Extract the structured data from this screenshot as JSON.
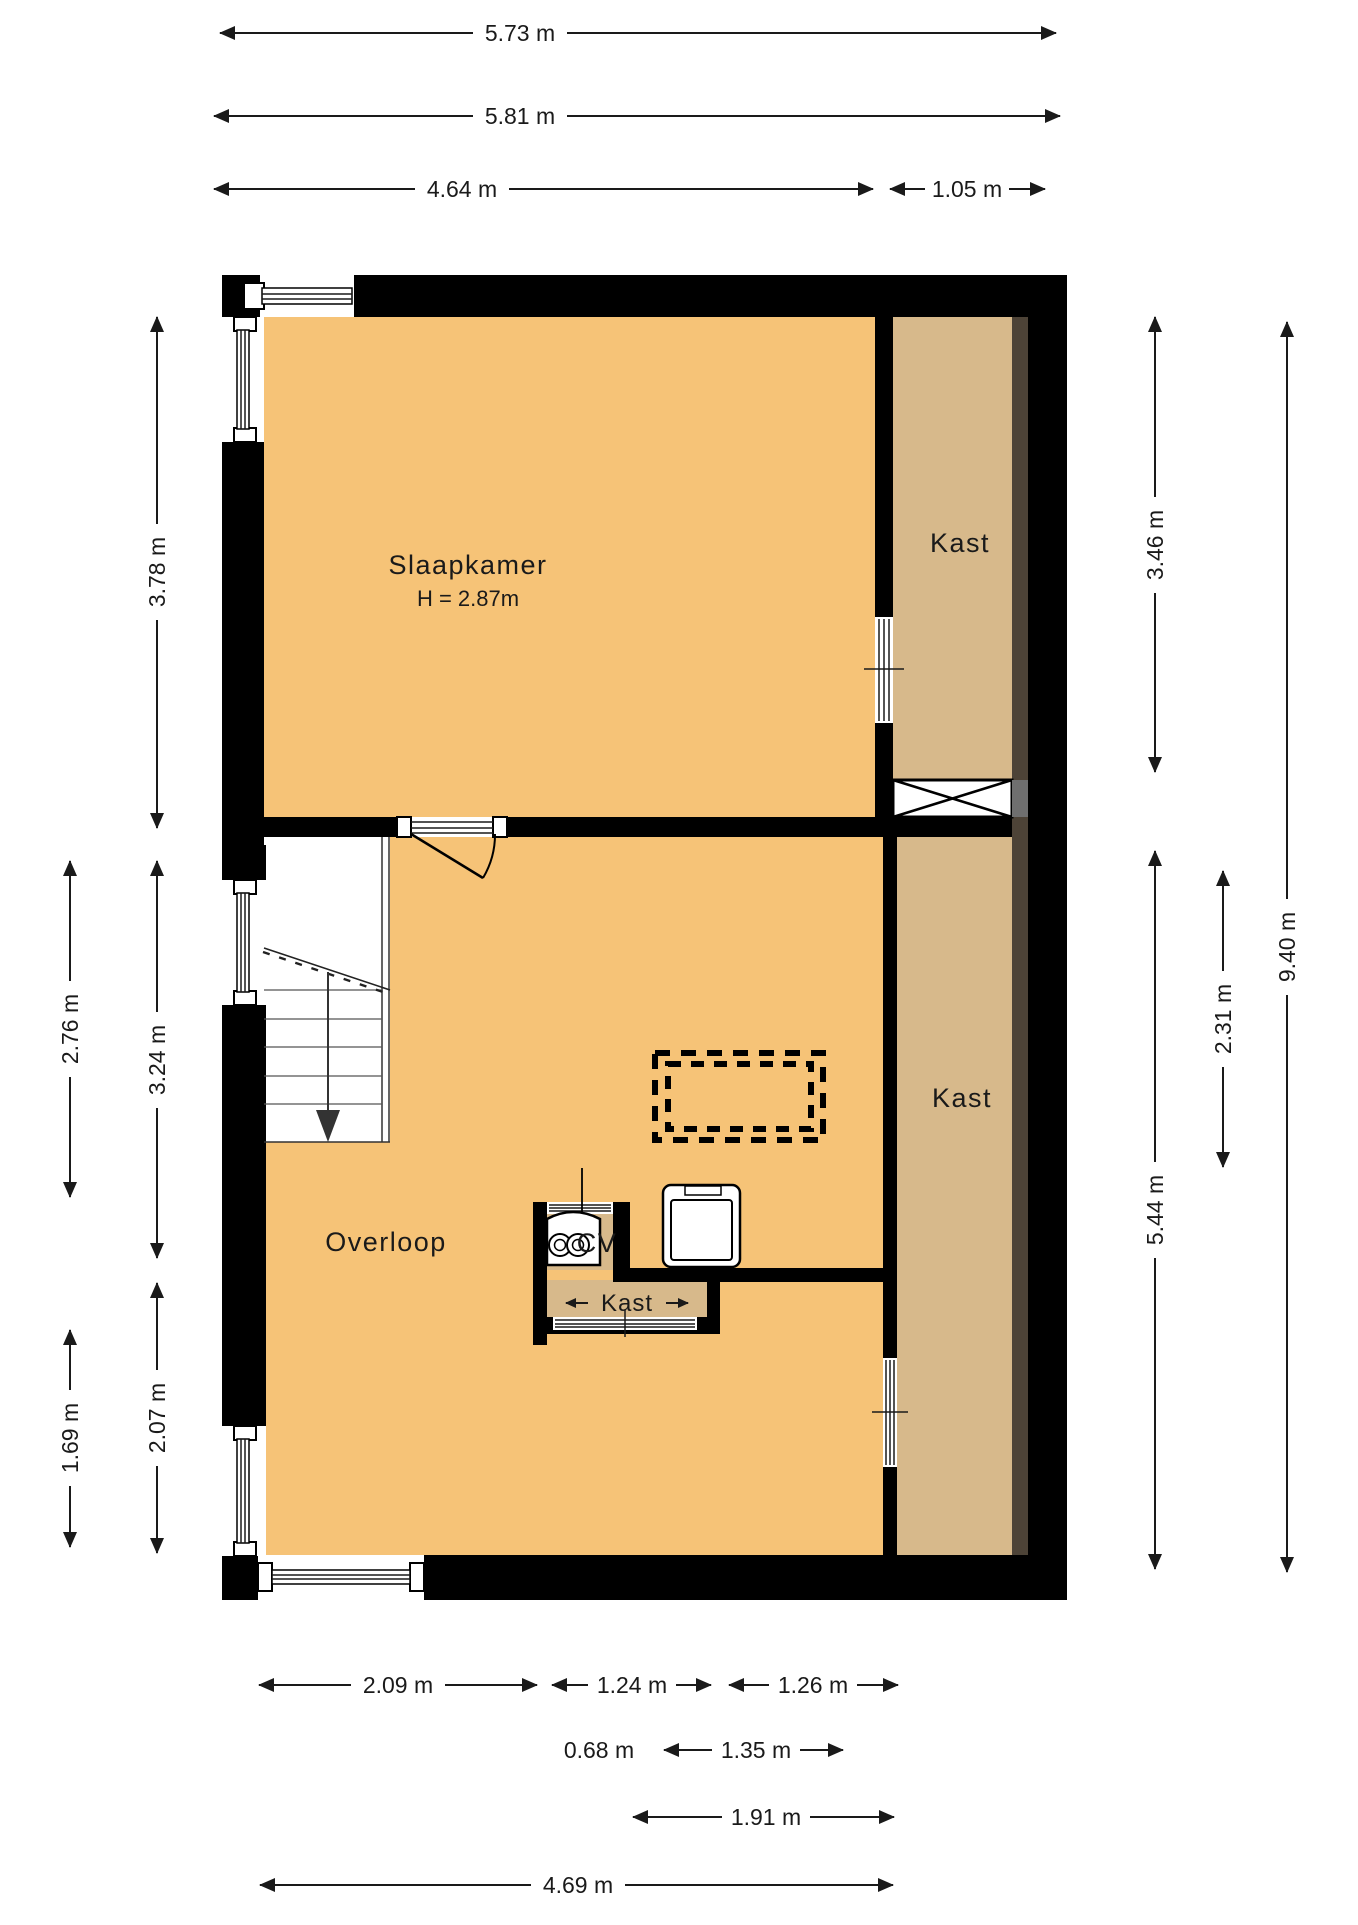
{
  "drawing": {
    "type": "floor-plan",
    "language": "nl"
  },
  "colors": {
    "wall": "#000000",
    "floor": "#F6C377",
    "closet": "#D7B98B",
    "wardrobe_strip": "#4D4337",
    "shaft_grey": "#6f6f6f",
    "paper": "#ffffff",
    "line": "#1a1a1a"
  },
  "rooms": {
    "slaapkamer": {
      "label": "Slaapkamer",
      "height_note": "H = 2.87m"
    },
    "kast_top": {
      "label": "Kast"
    },
    "kast_right": {
      "label": "Kast"
    },
    "kast_small": {
      "label": "Kast"
    },
    "overloop": {
      "label": "Overloop"
    },
    "cv": {
      "label": "CV"
    }
  },
  "dimensions": {
    "top": [
      {
        "label": "5.73 m"
      },
      {
        "label": "5.81 m"
      },
      {
        "label": "4.64 m"
      },
      {
        "label": "1.05 m"
      }
    ],
    "bottom": [
      {
        "label": "2.09 m"
      },
      {
        "label": "1.24 m"
      },
      {
        "label": "1.26 m"
      },
      {
        "label": "0.68 m"
      },
      {
        "label": "1.35 m"
      },
      {
        "label": "1.91 m"
      },
      {
        "label": "4.69 m"
      }
    ],
    "left": [
      {
        "label": "3.78 m"
      },
      {
        "label": "3.24 m"
      },
      {
        "label": "2.07 m"
      },
      {
        "label": "2.76 m"
      },
      {
        "label": "1.69 m"
      }
    ],
    "right": [
      {
        "label": "3.46 m"
      },
      {
        "label": "5.44 m"
      },
      {
        "label": "2.31 m"
      },
      {
        "label": "9.40 m"
      }
    ]
  }
}
